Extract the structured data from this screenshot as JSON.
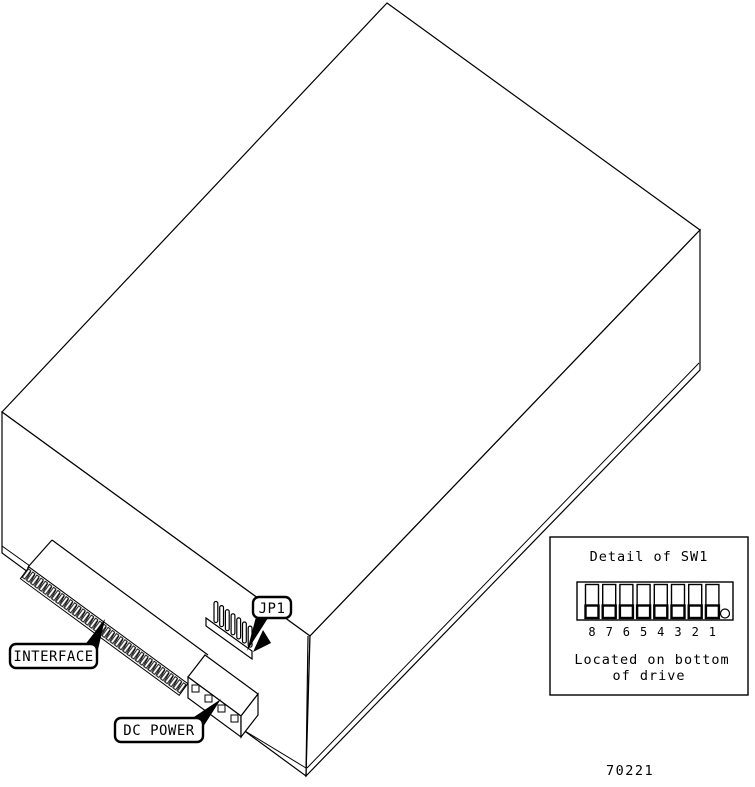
{
  "figure": {
    "number": "70221"
  },
  "labels": {
    "interface": "INTERFACE",
    "dc_power": "DC POWER",
    "jp1": "JP1"
  },
  "detail": {
    "title": "Detail of SW1",
    "switch_numbers": [
      "8",
      "7",
      "6",
      "5",
      "4",
      "3",
      "2",
      "1"
    ],
    "caption_line1": "Located on bottom",
    "caption_line2": "of drive"
  },
  "drawing": {
    "subject": "disk drive isometric view",
    "connectors": [
      "interface-edge-connector",
      "dc-power-connector",
      "jp1-jumper-header"
    ],
    "dip_switch_positions": 8
  },
  "colors": {
    "line": "#000000",
    "background": "#ffffff"
  }
}
